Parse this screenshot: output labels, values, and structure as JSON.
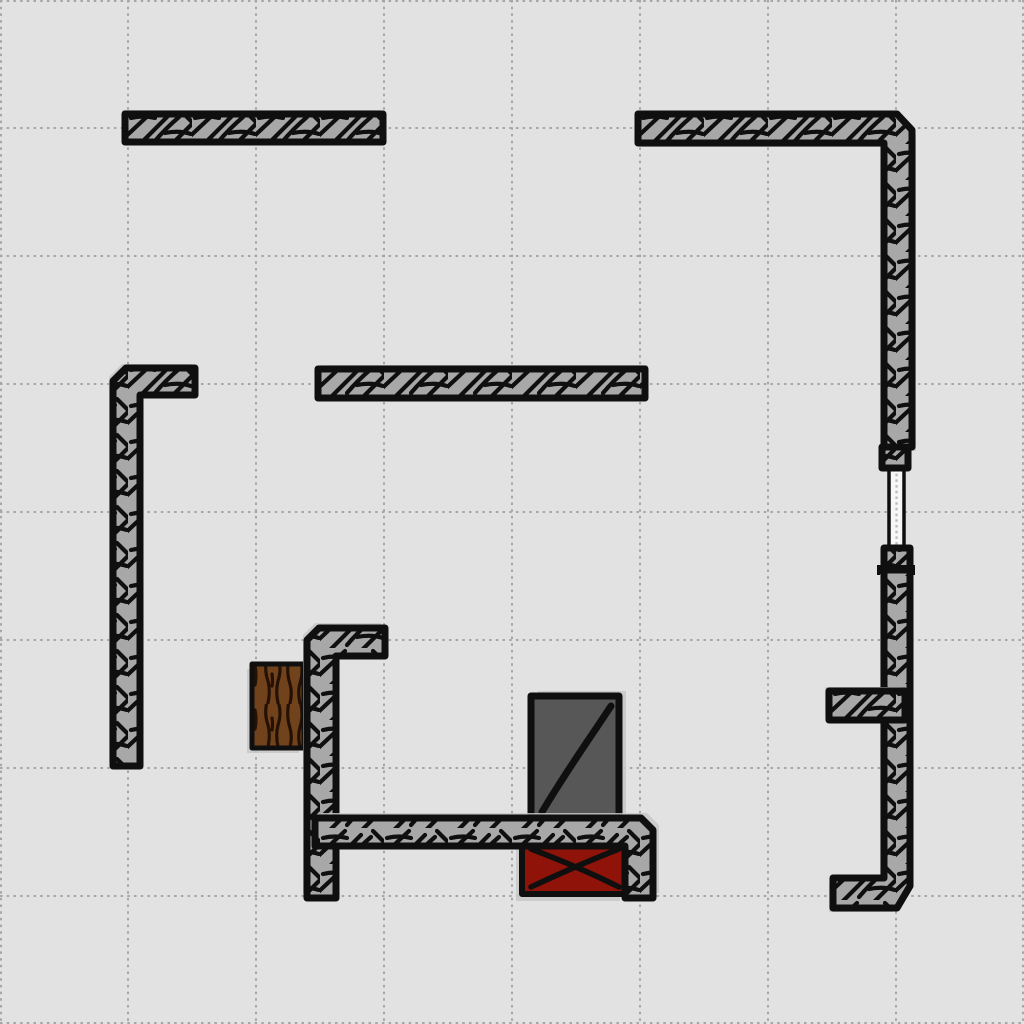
{
  "scene": {
    "width": 1024,
    "height": 1024,
    "background_color": "#e2e2e2",
    "grid": {
      "spacing": 128,
      "color": "#a6a6a6",
      "stroke_width": 2,
      "dash": "2.5 4.2"
    },
    "palette": {
      "wall_fill": "#a8a8a8",
      "ink": "#0f0f0f",
      "shadow": "#c7c7c7",
      "wood_fill": "#71431c",
      "wood_grain": "#241103",
      "metal_fill": "#575757",
      "danger_fill": "#8f1309",
      "rope_fill": "#f7f7f7",
      "rope_dots": "#b8b8b8"
    },
    "objects": [
      {
        "name": "wooden-crate",
        "type": "crate",
        "x": 252,
        "y": 664,
        "w": 52,
        "h": 84,
        "stroke_width": 5,
        "shadow": [
          -5,
          5
        ],
        "interactable": true
      },
      {
        "name": "metal-box",
        "type": "box",
        "x": 531,
        "y": 696,
        "w": 88,
        "h": 122,
        "fill": "metal_fill",
        "stroke_width": 7,
        "mark_width": 7,
        "marks": [
          "M542,812 C567,770 588,741 611,706"
        ],
        "shadow": [
          7,
          -5
        ],
        "interactable": true
      },
      {
        "name": "danger-box",
        "type": "box",
        "x": 522,
        "y": 842,
        "w": 104,
        "h": 52,
        "fill": "danger_fill",
        "stroke_width": 6,
        "mark_width": 5.5,
        "marks": [
          "M531,849 C563,861 595,875 619,887",
          "M531,887 C561,873 593,859 619,849"
        ],
        "shadow": [
          -6,
          7
        ],
        "interactable": true
      },
      {
        "name": "wall-top-left",
        "type": "wall",
        "points": [
          [
            125,
            114
          ],
          [
            383,
            114
          ],
          [
            383,
            142
          ],
          [
            125,
            142
          ]
        ],
        "shadow": [
          -3,
          -4
        ],
        "interactable": true
      },
      {
        "name": "wall-middle",
        "type": "wall",
        "points": [
          [
            318,
            369
          ],
          [
            645,
            369
          ],
          [
            645,
            398
          ],
          [
            318,
            398
          ]
        ],
        "shadow": [
          3,
          -4
        ],
        "interactable": true
      },
      {
        "name": "wall-top-right",
        "type": "wall",
        "points": [
          [
            638,
            114
          ],
          [
            897,
            114
          ],
          [
            912,
            130
          ],
          [
            912,
            447
          ],
          [
            884,
            447
          ],
          [
            884,
            143
          ],
          [
            638,
            143
          ]
        ],
        "shadow": [
          4,
          4
        ],
        "interactable": true
      },
      {
        "name": "rope",
        "type": "rope",
        "x": 889,
        "y": 459,
        "w": 15,
        "h": 97,
        "interactable": true
      },
      {
        "name": "rope-anchor-top",
        "type": "wall",
        "points": [
          [
            882,
            447
          ],
          [
            908,
            447
          ],
          [
            908,
            468
          ],
          [
            882,
            468
          ]
        ],
        "shadow": null,
        "interactable": true
      },
      {
        "name": "rope-anchor-bottom",
        "type": "wall",
        "points": [
          [
            884,
            548
          ],
          [
            910,
            548
          ],
          [
            910,
            570
          ],
          [
            884,
            570
          ]
        ],
        "shadow": null,
        "interactable": true
      },
      {
        "name": "rope-anchor-collar",
        "type": "bar",
        "x": 877,
        "y": 565,
        "w": 38,
        "h": 10,
        "interactable": true
      },
      {
        "name": "wall-right-lower",
        "type": "wall",
        "points": [
          [
            884,
            570
          ],
          [
            910,
            570
          ],
          [
            910,
            886
          ],
          [
            897,
            908
          ],
          [
            833,
            908
          ],
          [
            833,
            878
          ],
          [
            884,
            878
          ]
        ],
        "shadow": [
          -4,
          4
        ],
        "interactable": true
      },
      {
        "name": "wall-right-stub",
        "type": "wall",
        "points": [
          [
            829,
            691
          ],
          [
            905,
            691
          ],
          [
            905,
            720
          ],
          [
            829,
            720
          ]
        ],
        "shadow": [
          -4,
          -4
        ],
        "interactable": true
      },
      {
        "name": "wall-left",
        "type": "wall",
        "points": [
          [
            126,
            368
          ],
          [
            195,
            368
          ],
          [
            195,
            395
          ],
          [
            140,
            395
          ],
          [
            140,
            766
          ],
          [
            113,
            766
          ],
          [
            113,
            381
          ]
        ],
        "shadow": [
          -4,
          -4
        ],
        "interactable": true
      },
      {
        "name": "wall-bottom-vertical",
        "type": "wall",
        "points": [
          [
            319,
            628
          ],
          [
            385,
            628
          ],
          [
            385,
            656
          ],
          [
            336,
            656
          ],
          [
            336,
            898
          ],
          [
            307,
            898
          ],
          [
            307,
            640
          ]
        ],
        "shadow": [
          -4,
          -5
        ],
        "interactable": true
      },
      {
        "name": "wall-bottom-bar",
        "type": "wall",
        "points": [
          [
            315,
            818
          ],
          [
            641,
            818
          ],
          [
            653,
            830
          ],
          [
            653,
            898
          ],
          [
            625,
            898
          ],
          [
            625,
            846
          ],
          [
            315,
            846
          ]
        ],
        "shadow": [
          6,
          -5
        ],
        "interactable": true
      }
    ]
  }
}
